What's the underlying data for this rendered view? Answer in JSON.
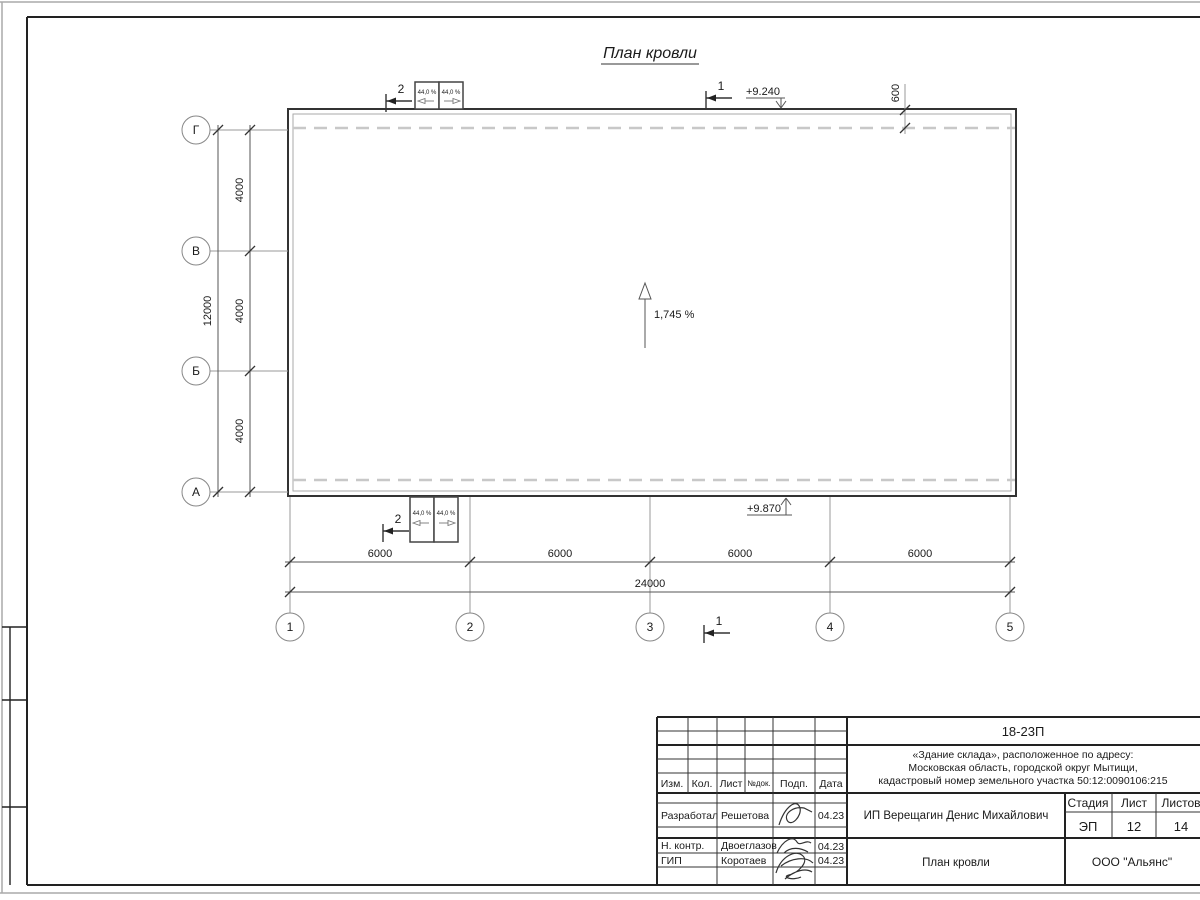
{
  "title": "План кровли",
  "plan": {
    "grid_rows": [
      "Г",
      "В",
      "Б",
      "А"
    ],
    "grid_cols": [
      "1",
      "2",
      "3",
      "4",
      "5"
    ],
    "dims_left": [
      "4000",
      "4000",
      "4000"
    ],
    "dim_left_total": "12000",
    "dims_bottom": [
      "6000",
      "6000",
      "6000",
      "6000"
    ],
    "dim_bottom_total": "24000",
    "overhang_dim": "600",
    "elevation_top": "+9.240",
    "elevation_bottom": "+9.870",
    "slope_main": "1,745 %",
    "slope_vents": [
      "44,0 %",
      "44,0 %",
      "44,0 %",
      "44,0 %"
    ],
    "section_marks": [
      "2",
      "1",
      "2",
      "1"
    ]
  },
  "titleblock": {
    "doc_number": "18-23П",
    "object_lines": [
      "«Здание склада», расположенное по адресу:",
      "Московская область, городской округ Мытищи,",
      "кадастровый номер земельного участка 50:12:0090106:215"
    ],
    "header_cols": [
      "Изм.",
      "Кол.",
      "Лист",
      "№док.",
      "Подп.",
      "Дата"
    ],
    "rows": [
      {
        "role": "Разработал",
        "name": "Решетова",
        "date": "04.23"
      },
      {
        "role": "Н. контр.",
        "name": "Двоеглазов",
        "date": "04.23"
      },
      {
        "role": "ГИП",
        "name": "Коротаев",
        "date": "04.23"
      }
    ],
    "client": "ИП Верещагин Денис Михайлович",
    "stage_label": "Стадия",
    "sheet_label": "Лист",
    "sheets_label": "Листов",
    "stage": "ЭП",
    "sheet": "12",
    "sheets": "14",
    "drawing_name": "План кровли",
    "company": "ООО \"Альянс\""
  }
}
